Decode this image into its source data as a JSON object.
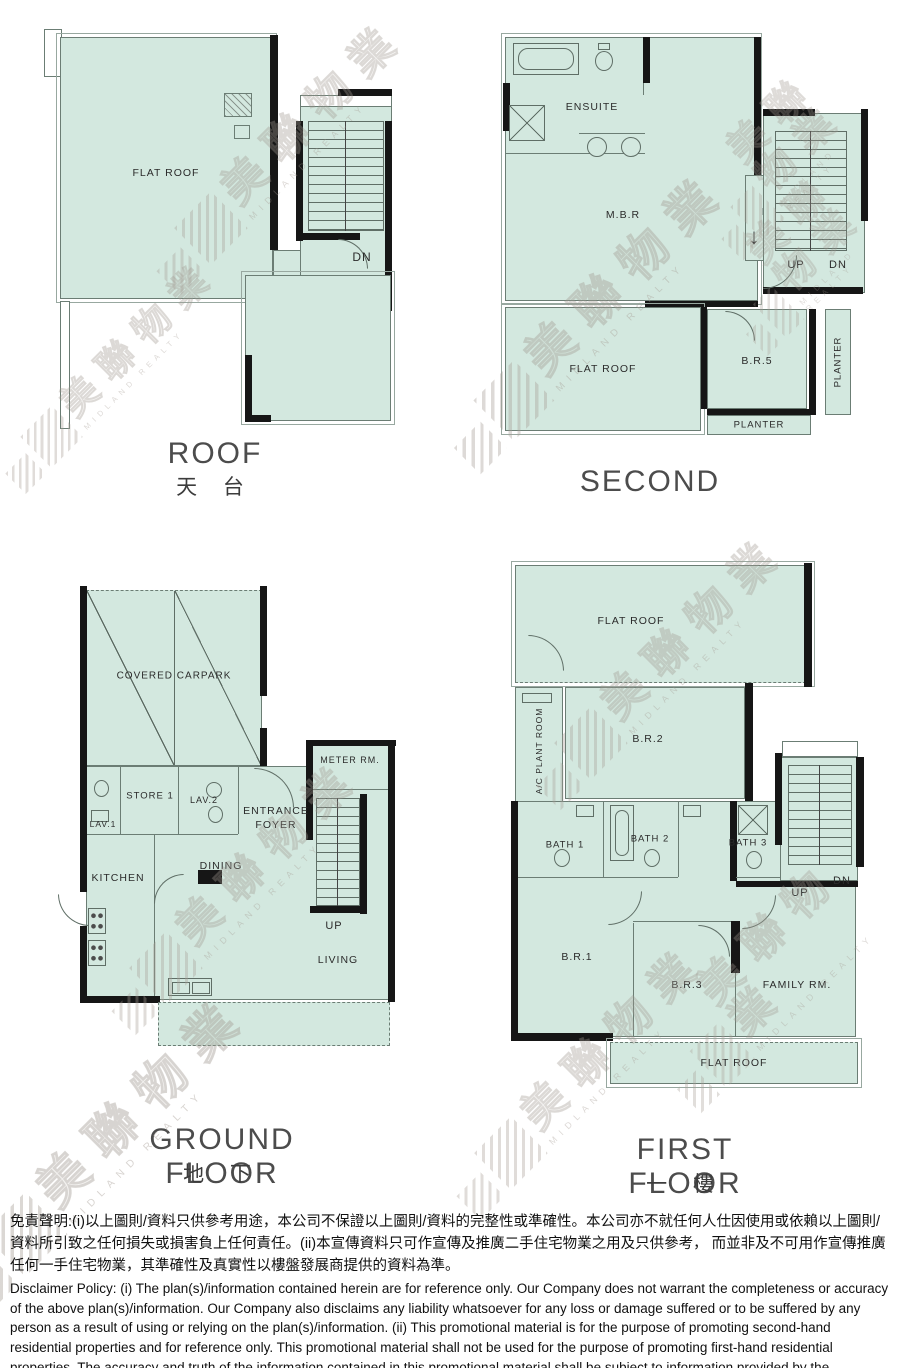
{
  "watermark": {
    "logo": "midland-logo-icon",
    "cjk": "美聯物業",
    "latin": "MIDLAND REALTY"
  },
  "icons": {
    "down_arrow": "↓"
  },
  "plans": {
    "roof": {
      "title": "ROOF",
      "subtitle": "天 台",
      "labels": {
        "flat_roof": "FLAT ROOF",
        "dn": "DN"
      }
    },
    "second": {
      "title": "SECOND",
      "labels": {
        "ensuite": "ENSUITE",
        "mbr": "M.B.R",
        "flat_roof": "FLAT ROOF",
        "up": "UP",
        "dn": "DN",
        "br5": "B.R.5",
        "planter": "PLANTER"
      }
    },
    "ground": {
      "title": "GROUND FLOOR",
      "subtitle": "地 下",
      "labels": {
        "covered_carpark": "COVERED CARPARK",
        "lav1": "LAV.1",
        "store1": "STORE 1",
        "lav2": "LAV.2",
        "meter_rm": "METER RM.",
        "entrance_foyer": "ENTRANCE FOYER",
        "kitchen": "KITCHEN",
        "dining": "DINING",
        "up": "UP",
        "living": "LIVING"
      }
    },
    "first": {
      "title": "FIRST FLOOR",
      "subtitle": "一 樓",
      "labels": {
        "flat_roof": "FLAT ROOF",
        "ac_plant_room": "A/C PLANT ROOM",
        "br2": "B.R.2",
        "bath1": "BATH 1",
        "bath2": "BATH 2",
        "bath3": "BATH 3",
        "up": "UP",
        "dn": "DN",
        "br1": "B.R.1",
        "br3": "B.R.3",
        "family_rm": "FAMILY RM."
      }
    }
  },
  "disclaimer": {
    "zh": "免責聲明:(i)以上圖則/資料只供參考用途，本公司不保證以上圖則/資料的完整性或準確性。本公司亦不就任何人仕因使用或依賴以上圖則/資料所引致之任何損失或損害負上任何責任。(ii)本宣傳資料只可作宣傳及推廣二手住宅物業之用及只供參考， 而並非及不可用作宣傳推廣任何一手住宅物業，其準確性及真實性以樓盤發展商提供的資料為準。",
    "en": "Disclaimer Policy: (i) The plan(s)/information contained herein are for reference only. Our Company does not warrant the completeness or accuracy of the above plan(s)/information. Our Company also disclaims any liability whatsoever for any loss or damage suffered or to be suffered by any person as a result of using or relying on the plan(s)/information. (ii) This promotional material is for the purpose of promoting second-hand residential properties and for reference only. This promotional material shall not be used for the purpose of promoting first-hand residential properties. The accuracy and truth of the information contained in this promotional material shall be subject to information provided by the developers."
  },
  "colors": {
    "plan_fill": "#d3e8df",
    "wall": "#161616",
    "watermark": "#a79e96"
  }
}
